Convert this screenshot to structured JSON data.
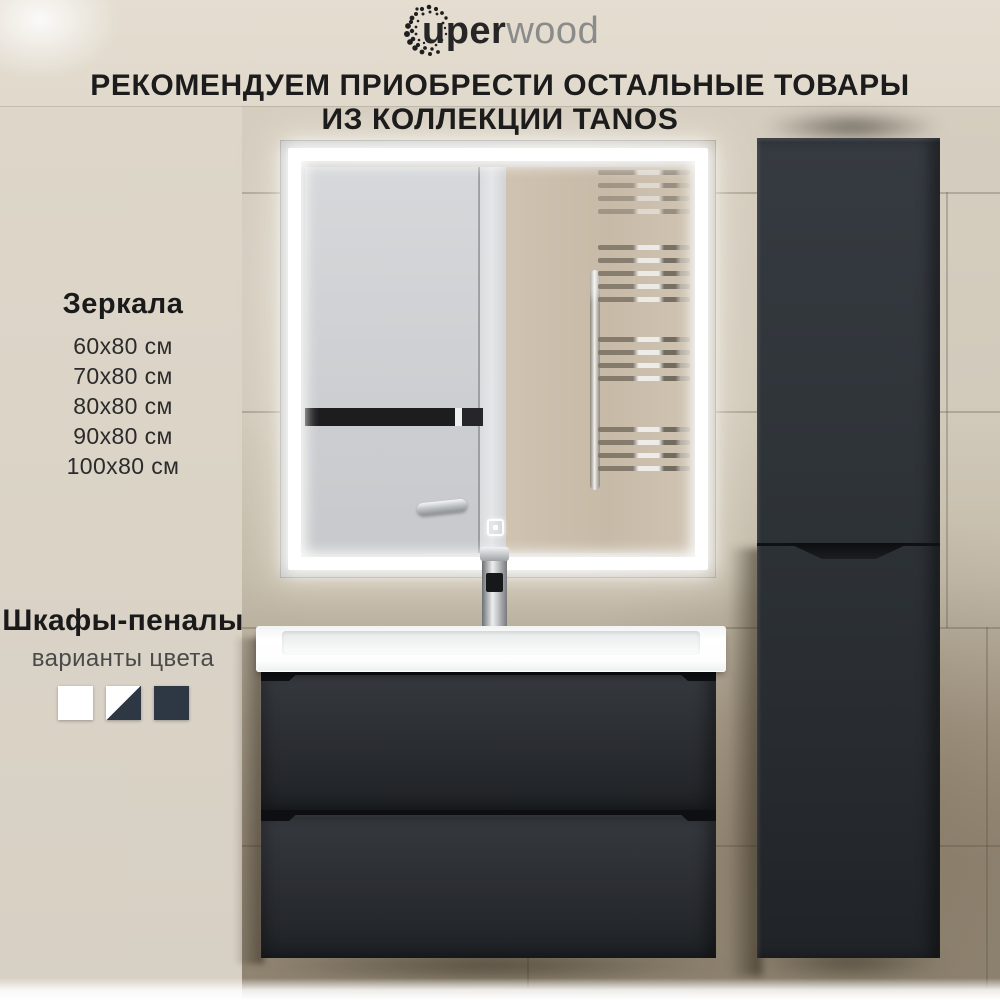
{
  "brand": {
    "logo_bold": "uper",
    "logo_light": "wood"
  },
  "heading": {
    "line1": "РЕКОМЕНДУЕМ ПРИОБРЕСТИ ОСТАЛЬНЫЕ ТОВАРЫ",
    "line2": "ИЗ КОЛЛЕКЦИИ TANOS"
  },
  "mirrors": {
    "title": "Зеркала",
    "sizes": [
      "60x80 см",
      "70x80 см",
      "80x80 см",
      "90x80 см",
      "100x80 см"
    ]
  },
  "cabinets": {
    "title": "Шкафы-пеналы",
    "subtitle": "варианты цвета",
    "swatches": [
      {
        "name": "white",
        "hex": "#ffffff"
      },
      {
        "name": "white-graphite",
        "hex": "#ffffff/#2e3744"
      },
      {
        "name": "graphite",
        "hex": "#2e3744"
      }
    ]
  },
  "scene": {
    "colors": {
      "furniture_graphite": "#2e3338",
      "wall_beige": "#d5cdbf",
      "led_white": "#ffffff",
      "sink_white": "#ffffff"
    }
  }
}
